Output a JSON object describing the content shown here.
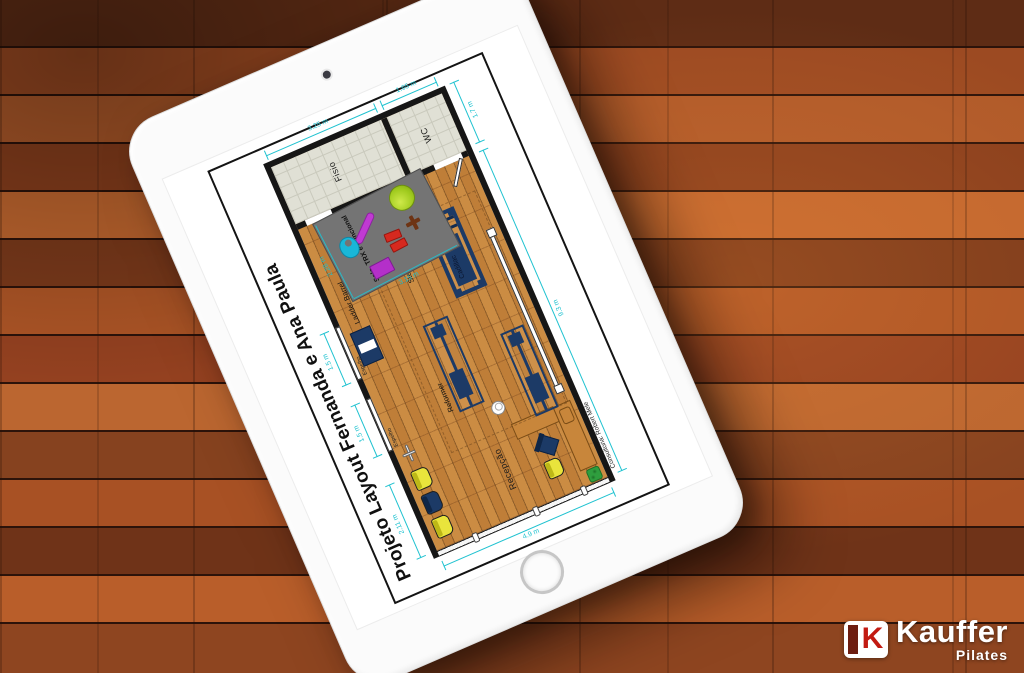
{
  "plan": {
    "title": "Projeto Layout Fernanda e Ana Paula",
    "credit": "Consultoria: Robert Mele",
    "rooms": {
      "fisio": "Fisio",
      "wc": "WC",
      "reception": "Recepção"
    },
    "mat": {
      "label": "Solo, TRX e Funcional",
      "depth": "2.28 m",
      "width": "3.15 m"
    },
    "equipment": {
      "ladder_barrel": "Ladder Barrel",
      "step_chair": "Step Chair",
      "cadillac": "Cadillac",
      "reformer": "Reformer"
    },
    "mirrors": {
      "m1": "Espelho",
      "m2": "Espelho"
    },
    "dimensions": {
      "fisio_width": "3.25 m",
      "wc_width": "1.65 m",
      "annex_depth": "1.7 m",
      "studio_length": "9.3 m",
      "front_width": "4.9 m",
      "reception_wall": "2.11 m",
      "mirror1": "1.5 m",
      "mirror2": "1.5 m"
    },
    "colors": {
      "dimension_accent": "#1fc2d0",
      "equipment_navy": "#1c3a66",
      "mat_gray": "#747474",
      "wall_black": "#161616"
    }
  },
  "logo": {
    "brand": "Kauffer",
    "sub": "Pilates"
  }
}
